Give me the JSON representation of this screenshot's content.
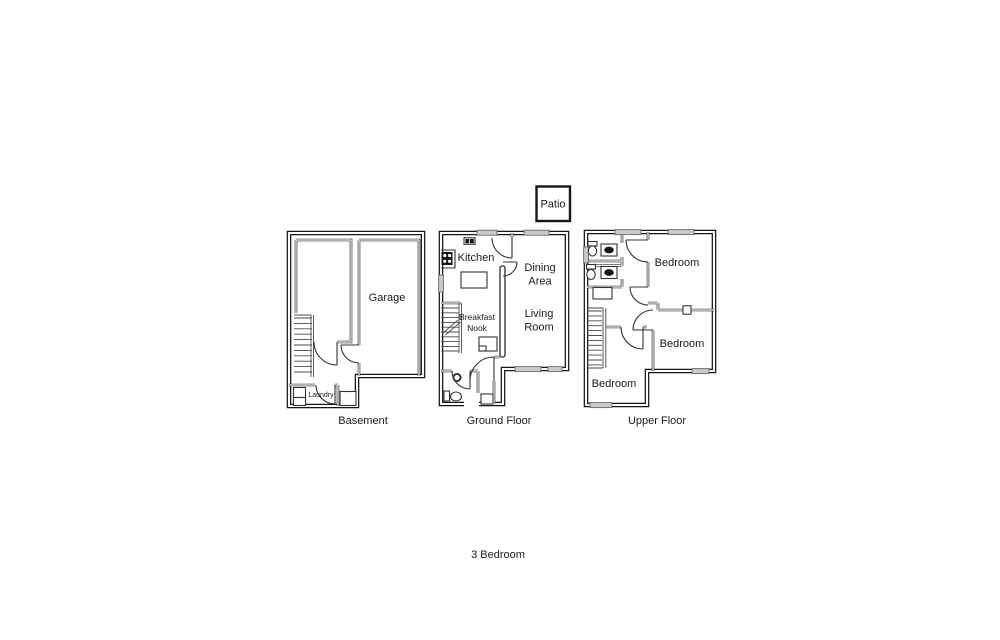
{
  "page_title": "3 Bedroom",
  "patio": {
    "label": "Patio"
  },
  "floors": {
    "basement": {
      "caption": "Basement",
      "garage": "Garage",
      "laundry": "Laundry"
    },
    "ground": {
      "caption": "Ground Floor",
      "kitchen": "Kitchen",
      "dining": [
        "Dining",
        "Area"
      ],
      "living": [
        "Living",
        "Room"
      ],
      "breakfast": [
        "Breakfast",
        "Nook"
      ]
    },
    "upper": {
      "caption": "Upper Floor",
      "bedroom_top_right": "Bedroom",
      "bedroom_mid_right": "Bedroom",
      "bedroom_bottom_left": "Bedroom"
    }
  },
  "colors": {
    "wall": "#161616",
    "window_fill": "#c9c9c9",
    "text": "#1a1a1a",
    "background": "#ffffff"
  }
}
